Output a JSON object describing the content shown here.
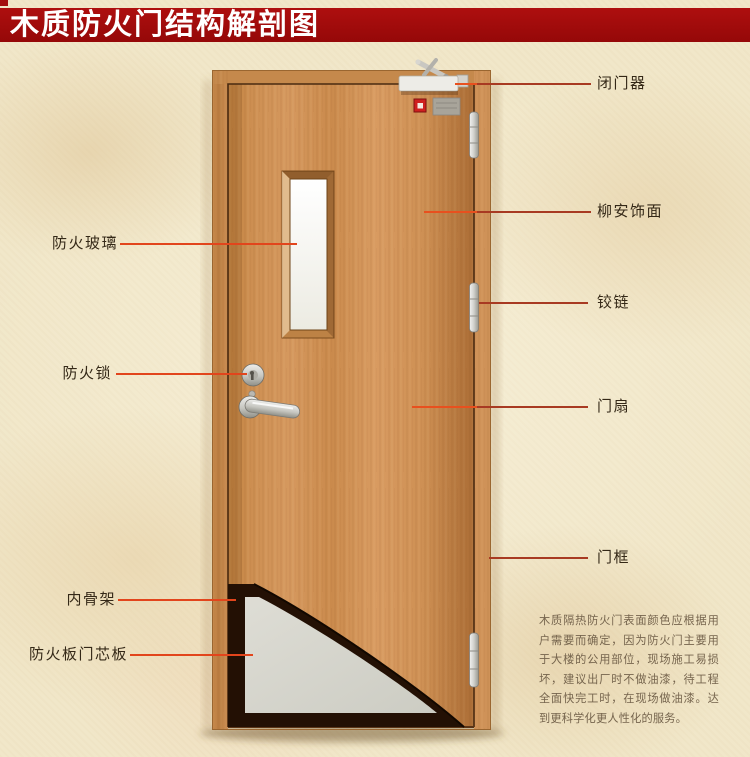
{
  "banner": {
    "title": "木质防火门结构解剖图",
    "bg_color": "#a40e0e",
    "text_color": "#ffffff"
  },
  "labels": {
    "left": [
      {
        "id": "fire-glass",
        "text": "防火玻璃"
      },
      {
        "id": "fire-lock",
        "text": "防火锁"
      },
      {
        "id": "inner-skeleton",
        "text": "内骨架"
      },
      {
        "id": "fire-board-core",
        "text": "防火板门芯板"
      }
    ],
    "right": [
      {
        "id": "door-closer",
        "text": "闭门器"
      },
      {
        "id": "lauan-veneer",
        "text": "柳安饰面"
      },
      {
        "id": "hinge",
        "text": "铰链"
      },
      {
        "id": "door-leaf",
        "text": "门扇"
      },
      {
        "id": "door-frame",
        "text": "门框"
      }
    ]
  },
  "description": "木质隔热防火门表面颜色应根据用户需要而确定，因为防火门主要用于大楼的公用部位，现场施工易损坏，建议出厂时不做油漆，待工程全面快完工时，在现场做油漆。达到更科学化更人性化的服务。",
  "colors": {
    "leader_line_bright": "#e8501e",
    "leader_line_dark": "#a83a22",
    "background": "#f1e7c9",
    "wood_mid": "#cd9054",
    "core_gray": "#d6d5cc",
    "skeleton_dark": "#231004",
    "label_text": "#342817",
    "description_text": "#75644d"
  }
}
